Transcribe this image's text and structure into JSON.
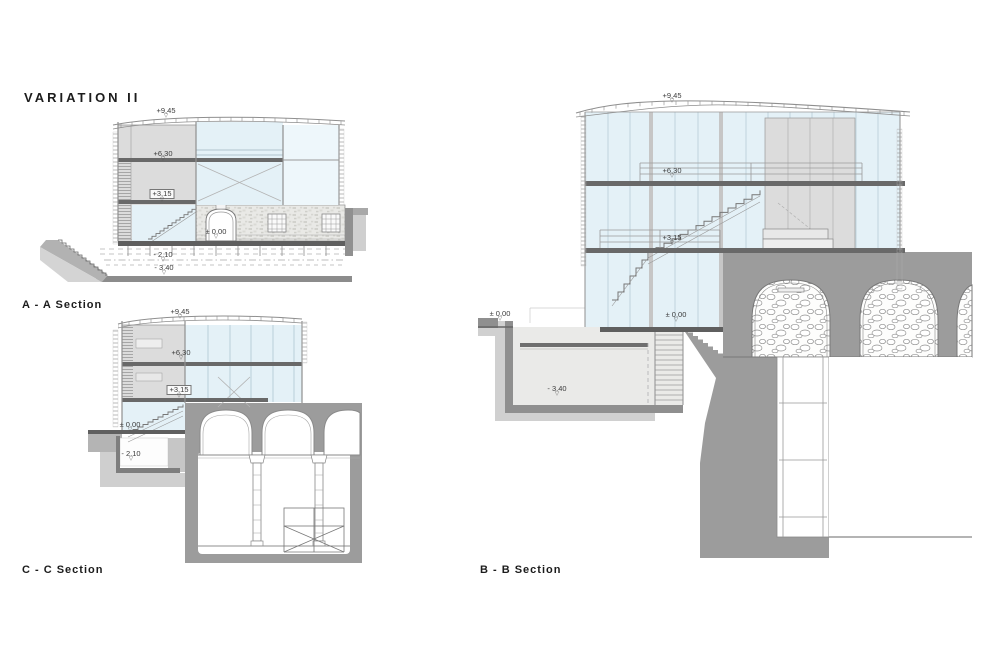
{
  "title": "VARIATION II",
  "sections": {
    "aa": {
      "label": "A - A Section",
      "markers": [
        {
          "label": "+9,45"
        },
        {
          "label": "+6,30"
        },
        {
          "label": "+3,15"
        },
        {
          "label": "± 0.00"
        },
        {
          "label": "- 2.10"
        },
        {
          "label": "- 3.40"
        }
      ]
    },
    "cc": {
      "label": "C - C Section",
      "markers": [
        {
          "label": "+9,45"
        },
        {
          "label": "+6,30"
        },
        {
          "label": "+3,15"
        },
        {
          "label": "± 0.00"
        },
        {
          "label": "- 2.10"
        }
      ]
    },
    "bb": {
      "label": "B - B Section",
      "markers": [
        {
          "label": "+9,45"
        },
        {
          "label": "+6,30"
        },
        {
          "label": "+3,15"
        },
        {
          "label": "± 0.00"
        },
        {
          "label": "± 0.00"
        },
        {
          "label": "- 3.40"
        }
      ]
    }
  },
  "colors": {
    "glass": "#e4f1f7",
    "earth": "#9c9c9c",
    "ground": "#b4b4b4",
    "panel": "#dcdcdc",
    "slab": "#696969"
  }
}
